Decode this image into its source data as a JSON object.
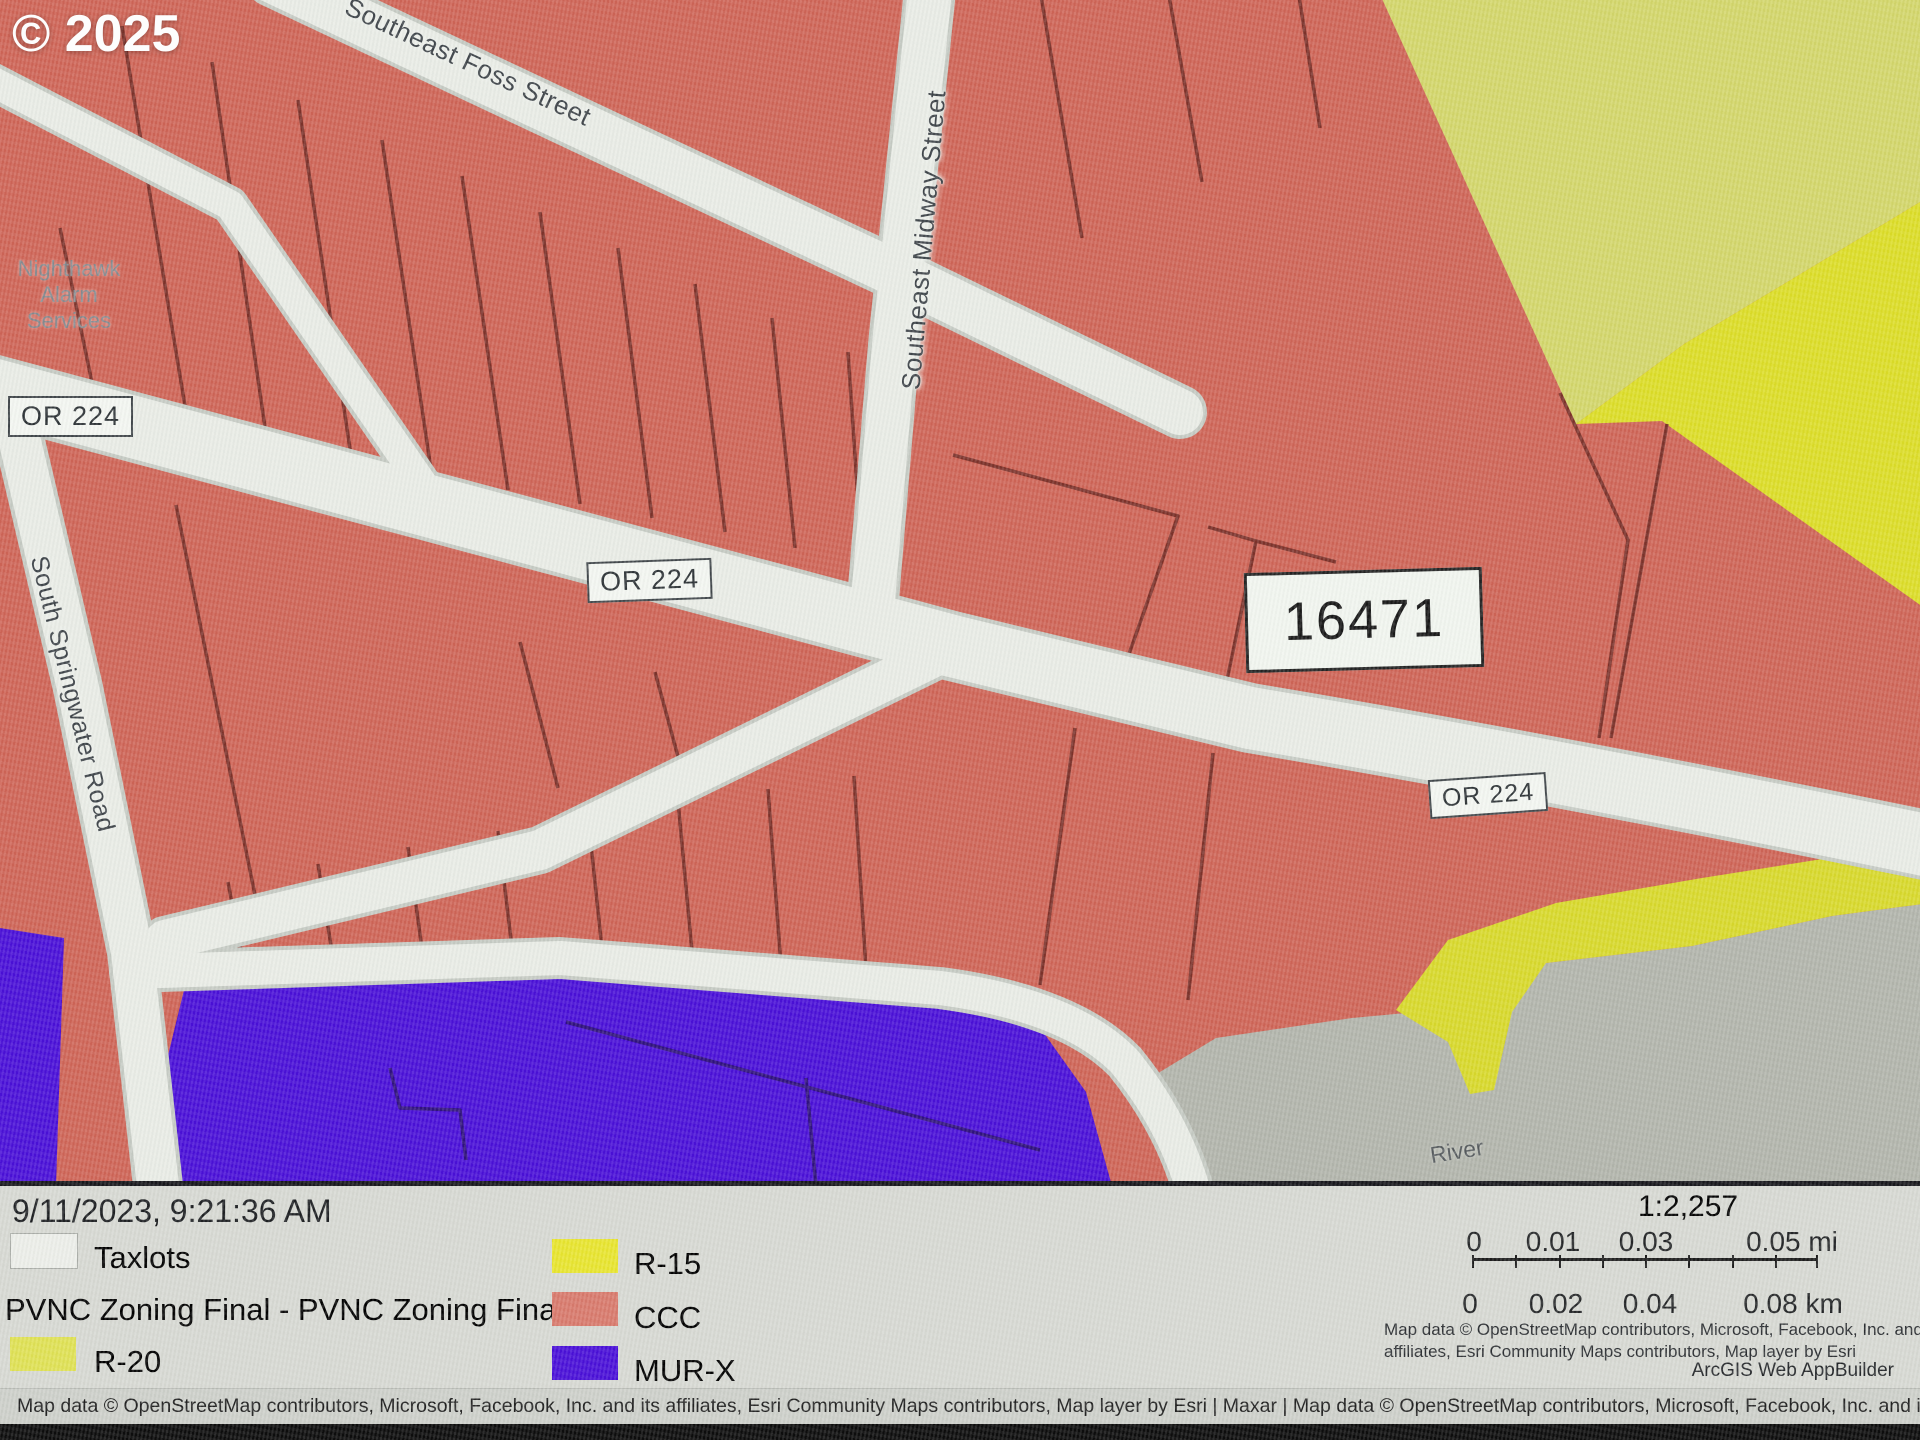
{
  "watermark": "© 2025",
  "map": {
    "streets": {
      "foss": "Southeast Foss Street",
      "midway": "Southeast Midway Street",
      "springwater": "South Springwater Road"
    },
    "route_shields": [
      "OR 224",
      "OR 224",
      "OR 224"
    ],
    "parcel_id": "16471",
    "poi": {
      "line1": "Nighthawk",
      "line2": "Alarm",
      "line3": "Services"
    },
    "river_label": "River",
    "zone_colors": {
      "ccc_fill": "#cf6557",
      "r20_fill": "#d3d66b",
      "r15_fill": "#dcdd28",
      "murx_fill": "#4a10d8",
      "unzoned_gray": "#b2b5ac",
      "road_fill": "#e9ece6",
      "parcel_line": "#7d332b"
    }
  },
  "legend": {
    "timestamp": "9/11/2023, 9:21:36 AM",
    "taxlots_label": "Taxlots",
    "layer_title": "PVNC Zoning Final - PVNC Zoning Final",
    "zones": [
      {
        "label": "R-20",
        "color": "#dfe155"
      },
      {
        "label": "R-15",
        "color": "#e8e52f"
      },
      {
        "label": "CCC",
        "color": "#d87a6d"
      },
      {
        "label": "MUR-X",
        "color": "#4a10d8"
      }
    ]
  },
  "scale": {
    "ratio": "1:2,257",
    "mi": [
      "0",
      "0.01",
      "0.03",
      "0.05 mi"
    ],
    "km": [
      "0",
      "0.02",
      "0.04",
      "0.08 km"
    ]
  },
  "attribution": {
    "esri_line1": "Map data © OpenStreetMap contributors, Microsoft, Facebook, Inc. and its",
    "esri_line2": "affiliates, Esri Community Maps contributors, Map layer by Esri",
    "app": "ArcGIS Web AppBuilder",
    "bottom_bar": "Map data © OpenStreetMap contributors, Microsoft, Facebook, Inc. and its affiliates, Esri Community Maps contributors, Map layer by Esri | Maxar | Map data © OpenStreetMap contributors, Microsoft, Facebook, Inc. and its affiliates, Esri Community Maps contributors,"
  }
}
